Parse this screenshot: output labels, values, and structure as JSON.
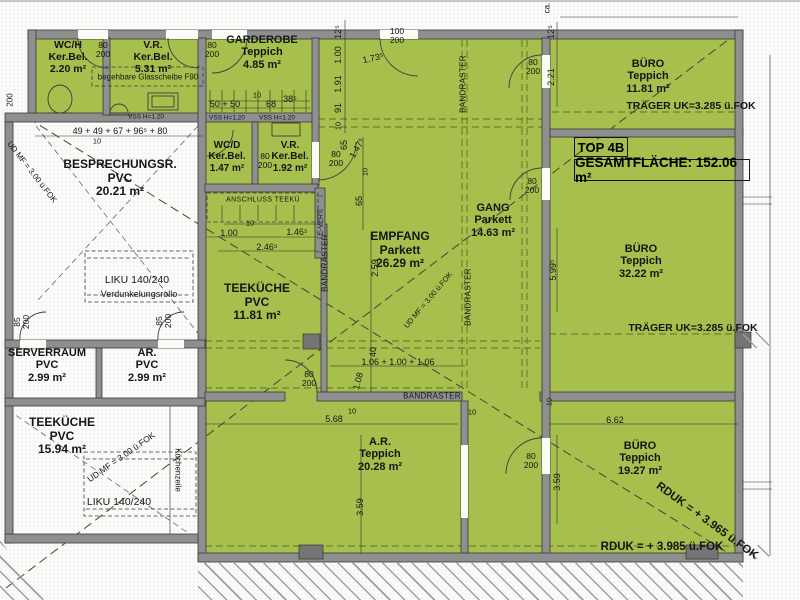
{
  "title": {
    "unit": "TOP 4B",
    "total": "GESAMTFLÄCHE: 152.06 m²"
  },
  "rooms": {
    "wch": {
      "name": "WC/H",
      "floor": "Ker.Bel.",
      "area": "2.20 m²"
    },
    "vr1": {
      "name": "V.R.",
      "floor": "Ker.Bel.",
      "area": "5.31 m²"
    },
    "gard": {
      "name": "GARDEROBE",
      "floor": "Teppich",
      "area": "4.85 m²"
    },
    "wcd": {
      "name": "WC/D",
      "floor": "Ker.Bel.",
      "area": "1.47 m²"
    },
    "vr2": {
      "name": "V.R.",
      "floor": "Ker.Bel.",
      "area": "1.92 m²"
    },
    "bespr": {
      "name": "BESPRECHUNGSR.",
      "floor": "PVC",
      "area": "20.21 m²"
    },
    "tk11": {
      "name": "TEEKÜCHE",
      "floor": "PVC",
      "area": "11.81 m²"
    },
    "empf": {
      "name": "EMPFANG",
      "floor": "Parkett",
      "area": "26.29 m²"
    },
    "gang": {
      "name": "GANG",
      "floor": "Parkett",
      "area": "14.63 m²"
    },
    "buero1": {
      "name": "BÜRO",
      "floor": "Teppich",
      "area": "11.81 m²"
    },
    "buero2": {
      "name": "BÜRO",
      "floor": "Teppich",
      "area": "32.22 m²"
    },
    "buero3": {
      "name": "BÜRO",
      "floor": "Teppich",
      "area": "19.27 m²"
    },
    "ar": {
      "name": "A.R.",
      "floor": "Teppich",
      "area": "20.28 m²"
    },
    "srv": {
      "name": "SERVERRAUM",
      "floor": "PVC",
      "area": "2.99 m²"
    },
    "arkl": {
      "name": "AR.",
      "floor": "PVC",
      "area": "2.99 m²"
    },
    "tk15": {
      "name": "TEEKÜCHE",
      "floor": "PVC",
      "area": "15.94 m²"
    }
  },
  "annotations": {
    "glass": "begehbare Glasscheibe F90",
    "anschluss": "ANSCHLUSS TEEKÜ",
    "liku": "LIKU 140/240",
    "rollo": "Verdunkelungsrollo",
    "kueche_zeile": "Küchenzeile",
    "evert": "E-VERT.",
    "bandraster": "BANDRASTER",
    "traeger": "TRÄGER UK=3.285 ü.FOK",
    "rduk_diag": "RDUK = + 3.965 ü.FOK",
    "rduk_horiz": "RDUK = + 3.985 ü.FOK",
    "udmf": "UD MF = 3.00 ü.FOK",
    "vss": "VSS H=1.20",
    "ca": "ca."
  },
  "doors": {
    "w80": "80",
    "w85": "85",
    "w100": "100",
    "h200": "200"
  },
  "dims": {
    "d10": "10",
    "d40": "40",
    "d65": "65",
    "d68": "68",
    "d91": "91",
    "d385": "38⁵",
    "d125": "12⁵",
    "d200": "200",
    "d50_50": "50 + 50",
    "row_besprechung": "49 + 49 + 67 + 96⁵ + 80",
    "d100": "1.00",
    "d1465": "1.46⁵",
    "d2465": "2.46⁵",
    "d173": "1.73⁵",
    "d1475": "1.47⁵",
    "d191": "1.91",
    "d221": "2.21",
    "d259": "2.59",
    "row_center": "1.06 + 1.00 + 1.06",
    "d108": "1.08",
    "d568": "5.68",
    "d359": "3.59",
    "d662": "6.62",
    "d5995": "5.99⁵"
  },
  "colors": {
    "unit_green": "#a6bf4d",
    "wall_gray": "#8f8f8f"
  }
}
